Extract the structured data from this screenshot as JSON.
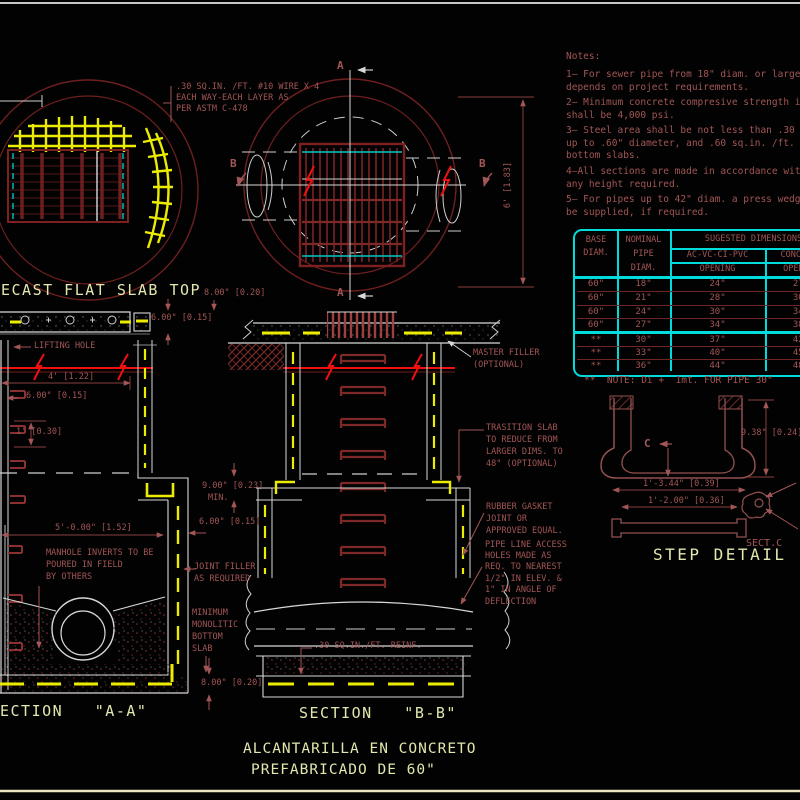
{
  "colors": {
    "background": "#020202",
    "linework": "#dadada",
    "dark_red": "#6e1f1f",
    "annotation_red": "#a35656",
    "bright_red": "#f01010",
    "rebar_yellow": "#ecec00",
    "title_yellow": "#e3e7ad",
    "table_cyan": "#00dcdc"
  },
  "wire_note": {
    "l1": ".30 SQ.IN. /FT. #10 WIRE X 4",
    "l2": "EACH WAY-EACH LAYER AS",
    "l3": "PER ASTM C-478"
  },
  "top_left_view": {
    "title": "ECAST FLAT SLAB TOP"
  },
  "plan_view": {
    "a_top": "A",
    "a_bottom": "A",
    "b_left": "B",
    "b_right": "B",
    "dim_height": "6' [1.83]"
  },
  "notes": {
    "heading": "Notes:",
    "n1": [
      "1— For sewer pipe from 18\" diam. or larger optio",
      "depends on project requirements."
    ],
    "n2": [
      "2— Minimum concrete compresive strength in all s",
      "shall be 4,000 psi."
    ],
    "n3": [
      "3— Steel area shall be not less than .30 sq.in. /",
      "up to .60\" diameter, and .60 sq.in. /ft. in larger",
      "bottom slabs."
    ],
    "n4": [
      "4—All sections are made in accordance with ASTM",
      "any height required."
    ],
    "n5": [
      "5— For pipes up to 42\" diam. a press wedge con",
      "be supplied, if required."
    ]
  },
  "table": {
    "col1_header": [
      "BASE",
      "DIAM."
    ],
    "col2_header": [
      "NOMINAL",
      "PIPE",
      "DIAM."
    ],
    "span_header": "SUGESTED DIMENSIONS",
    "col3_header": [
      "AC-VC-CI-PVC",
      "OPENING"
    ],
    "col4_header": [
      "CONCRETE",
      "OPENING"
    ],
    "rows": [
      [
        "60\"",
        "18\"",
        "24\"",
        "27\""
      ],
      [
        "60\"",
        "21\"",
        "28\"",
        "30\""
      ],
      [
        "60\"",
        "24\"",
        "30\"",
        "34\""
      ],
      [
        "60\"",
        "27\"",
        "34\"",
        "38\""
      ],
      [
        "**",
        "30\"",
        "37\"",
        "42\""
      ],
      [
        "**",
        "33\"",
        "40\"",
        "45\""
      ],
      [
        "**",
        "36\"",
        "44\"",
        "48\""
      ]
    ],
    "footnote": "**  NOTE: Di +  1mt. FOR PIPE 30\""
  },
  "section_a": {
    "title": "ECTION   \"A-A\"",
    "lifting_hole": "LIFTING HOLE",
    "dim_8_top": "8.00\" [0.20]",
    "dim_6_top": "6.00\" [0.15]",
    "dim_4": "4' [1.22]",
    "dim_6_left": "6.00\" [0.15]",
    "dim_1ft": "1' [0.30]",
    "dim_5ft": "5'-0.00\" [1.52]",
    "dim_9": "9.00\" [0.23]",
    "dim_9_min": "MIN.",
    "dim_6_right": "6.00\" [0.15]",
    "dim_8_bottom": "8.00\" [0.20]",
    "manhole_note": [
      "MANHOLE INVERTS TO BE",
      "POURED IN FIELD",
      "BY OTHERS"
    ],
    "joint_filler": [
      "JOINT FILLER",
      "AS REQUIRED"
    ],
    "monolithic": [
      "MINIMUM",
      "MONOLITIC",
      "BOTTOM",
      "SLAB"
    ]
  },
  "section_b": {
    "title": "SECTION   \"B-B\"",
    "master_filler": [
      "MASTER FILLER",
      "(OPTIONAL)"
    ],
    "transition": [
      "TRASITION SLAB",
      "TO REDUCE FROM",
      "LARGER DIMS. TO",
      "48\" (OPTIONAL)"
    ],
    "rubber_gasket": [
      "RUBBER GASKET",
      "JOINT OR",
      "APPROVED EQUAL."
    ],
    "pipe_access": [
      "PIPE LINE ACCESS",
      "HOLES MADE AS",
      "REQ. TO NEAREST",
      "1/2\" IN ELEV. &",
      "1\" IN ANGLE OF",
      "DEFLECTION"
    ],
    "reinf_note": ".30 SQ.IN./FT. REINF."
  },
  "step_detail": {
    "title": "STEP DETAIL",
    "marker_c": "C",
    "dim_938": "9.38\" [0.24]",
    "dim_1344": "1'-3.44\" [0.39]",
    "dim_1200": "1'-2.00\" [0.36]",
    "sect_c": "SECT.C"
  },
  "drawing_title": [
    "ALCANTARILLA EN CONCRETO",
    "PREFABRICADO DE 60\""
  ]
}
